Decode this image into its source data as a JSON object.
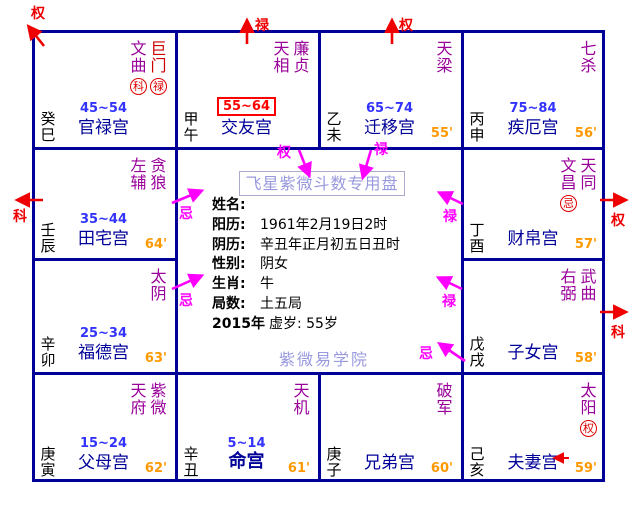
{
  "app": {
    "title_box": "飞星紫微斗数专用盘",
    "watermark": "紫微易学院"
  },
  "center": {
    "fields": [
      {
        "label": "姓名:",
        "value": ""
      },
      {
        "label": "阳历:",
        "value": "1961年2月19日2时"
      },
      {
        "label": "阴历:",
        "value": "辛丑年正月初五日丑时"
      },
      {
        "label": "性别:",
        "value": "阴女"
      },
      {
        "label": "生肖:",
        "value": "牛"
      },
      {
        "label": "局数:",
        "value": "土五局"
      },
      {
        "label": "2015年",
        "value": "虚岁: 55岁"
      }
    ]
  },
  "palaces": [
    {
      "name": "官禄宫",
      "stem": "癸巳",
      "age": "45~54",
      "stars": [
        {
          "name": "文曲",
          "mark": "科"
        },
        {
          "name": "巨门",
          "mark": "禄"
        }
      ]
    },
    {
      "name": "交友宫",
      "stem": "甲午",
      "age": "55~64",
      "stars": [
        {
          "name": "天相"
        },
        {
          "name": "廉贞"
        }
      ]
    },
    {
      "name": "迁移宫",
      "stem": "乙未",
      "age": "65~74",
      "minute": "55'",
      "stars": [
        {
          "name": "天梁"
        }
      ]
    },
    {
      "name": "疾厄宫",
      "stem": "丙申",
      "age": "75~84",
      "minute": "56'",
      "stars": [
        {
          "name": "七杀"
        }
      ]
    },
    {
      "name": "田宅宫",
      "stem": "壬辰",
      "age": "35~44",
      "minute": "64'",
      "stars": [
        {
          "name": "左辅"
        },
        {
          "name": "贪狼"
        }
      ]
    },
    {
      "name": "财帛宫",
      "stem": "丁酉",
      "minute": "57'",
      "stars": [
        {
          "name": "文昌",
          "mark": "忌"
        },
        {
          "name": "天同"
        }
      ]
    },
    {
      "name": "福德宫",
      "stem": "辛卯",
      "age": "25~34",
      "minute": "63'",
      "stars": [
        {
          "name": "太阴"
        }
      ]
    },
    {
      "name": "子女宫",
      "stem": "戊戌",
      "minute": "58'",
      "stars": [
        {
          "name": "右弼"
        },
        {
          "name": "武曲"
        }
      ]
    },
    {
      "name": "父母宫",
      "stem": "庚寅",
      "age": "15~24",
      "minute": "62'",
      "stars": [
        {
          "name": "天府"
        },
        {
          "name": "紫微"
        }
      ]
    },
    {
      "name": "命宫",
      "stem": "辛丑",
      "age": "5~14",
      "minute": "61'",
      "stars": [
        {
          "name": "天机"
        }
      ]
    },
    {
      "name": "兄弟宫",
      "stem": "庚子",
      "minute": "60'",
      "stars": [
        {
          "name": "破军"
        }
      ]
    },
    {
      "name": "夫妻宫",
      "stem": "己亥",
      "minute": "59'",
      "stars": [
        {
          "name": "太阳",
          "mark": "权"
        }
      ]
    }
  ],
  "arrows": {
    "red": [
      {
        "label": "权"
      },
      {
        "label": "禄"
      },
      {
        "label": "权"
      },
      {
        "label": "科"
      },
      {
        "label": "权"
      },
      {
        "label": "科"
      }
    ],
    "magenta": [
      {
        "label": "权"
      },
      {
        "label": "禄"
      },
      {
        "label": "忌"
      },
      {
        "label": "忌"
      },
      {
        "label": "禄"
      },
      {
        "label": "禄"
      },
      {
        "label": "忌"
      }
    ]
  },
  "colors": {
    "grid": "#000099",
    "star": "#990099",
    "star_highlight": "#CC0000",
    "palace_name": "#000099",
    "age": "#3333FF",
    "age_highlight": "#FF0000",
    "minute": "#FF9900",
    "transform_mark": "#DD0000",
    "red_arrow": "#EE0000",
    "magenta_arrow": "#FF00FF",
    "watermark": "#9999DD"
  }
}
